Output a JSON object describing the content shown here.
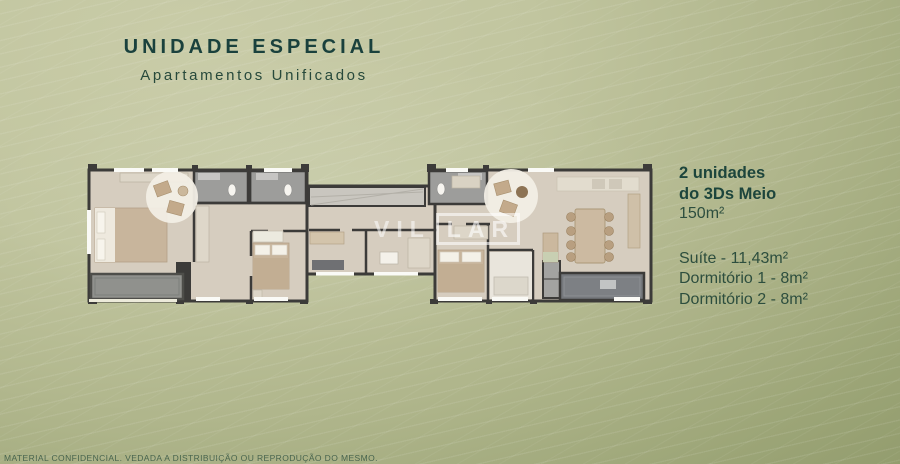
{
  "header": {
    "title": "UNIDADE ESPECIAL",
    "subtitle": "Apartamentos Unificados"
  },
  "info_panel": {
    "headline_line1": "2 unidades",
    "headline_line2": "do 3Ds Meio",
    "total_area": "150m²",
    "rooms": [
      "Suíte - 11,43m²",
      "Dormitório 1 - 8m²",
      "Dormitório 2 - 8m²"
    ]
  },
  "floor_plan": {
    "watermark": {
      "part1": "VIL",
      "part2": "LAR"
    }
  },
  "footer": {
    "disclaimer": "MATERIAL CONFIDENCIAL. VEDADA A DISTRIBUIÇÃO OU REPRODUÇÃO DO MESMO."
  },
  "colors": {
    "title_teal": "#1a413d",
    "text_green": "#2d4e3e",
    "background_light": "#c9cca8",
    "background_dark": "#849058",
    "plan_floor": "#d6cdbf",
    "plan_wall": "#3c3b39",
    "watermark_white": "#ffffff"
  }
}
